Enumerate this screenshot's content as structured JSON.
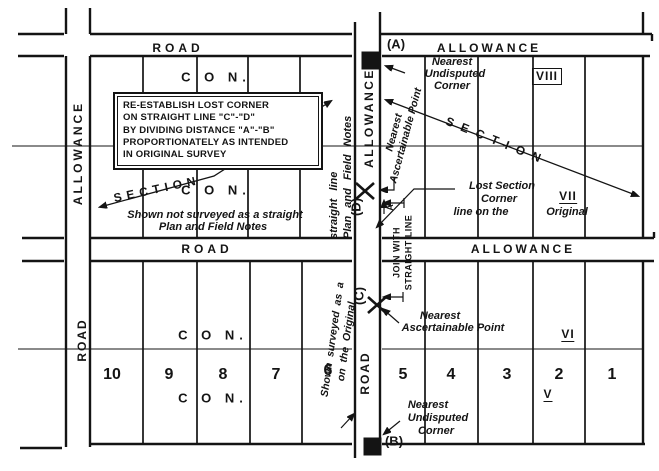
{
  "title": "Re-establishing a lost section corner — survey sketch",
  "colors": {
    "ink": "#141414",
    "bg": "#ffffff"
  },
  "roads": {
    "top": "ROAD",
    "top_right": "ALLOWANCE",
    "middle": "ROAD",
    "middle_right": "ALLOWANCE",
    "left_upper": "ALLOWANCE",
    "left_lower": "ROAD",
    "central_upper": "ALLOWANCE",
    "central_lower": "ROAD"
  },
  "note_box": {
    "lines": [
      "RE-ESTABLISH LOST CORNER",
      "ON STRAIGHT LINE \"C\"-\"D\"",
      "BY DIVIDING DISTANCE \"A\"-\"B\"",
      "PROPORTIONATELY AS INTENDED",
      "IN ORIGINAL SURVEY"
    ]
  },
  "section_labels": {
    "left": "SECTION",
    "right": "SECTION"
  },
  "concession_labels": {
    "top_upper": "C O N.",
    "top_lower": "C O N.",
    "bottom_upper": "C O N.",
    "bottom_lower": "C O N."
  },
  "concession_numerals": {
    "viii": "VIII",
    "vii": "VII",
    "vi": "VI",
    "v": "V"
  },
  "lots": {
    "bottom_left": [
      "10",
      "9",
      "8",
      "7",
      "6"
    ],
    "bottom_right": [
      "5",
      "4",
      "3",
      "2",
      "1"
    ]
  },
  "points": {
    "a": "(A)",
    "b": "(B)",
    "c": "(C)",
    "d": "(D)",
    "dim": "A"
  },
  "annotations": {
    "nearest_undisputed_top": {
      "l1": "Nearest",
      "l2": "Undisputed",
      "l3": "Corner"
    },
    "nearest_undisputed_bottom": {
      "l1": "Nearest",
      "l2": "Undisputed",
      "l3": "Corner"
    },
    "nearest_ascertainable_top": {
      "l1": "Nearest",
      "l2": "Ascertainable Point"
    },
    "nearest_ascertainable_bottom": {
      "l1": "Nearest",
      "l2": "Ascertainable Point"
    },
    "lost_corner": {
      "l1": "Lost Section",
      "l2": "Corner",
      "l3": "line on the",
      "l4": "Original"
    },
    "join": {
      "l1": "JOIN WITH",
      "l2": "STRAIGHT LINE"
    },
    "shown_not": {
      "l1": "Shown not surveyed as a straight",
      "l2": "Plan and Field Notes"
    },
    "straight_plan": {
      "l1": "straight line",
      "l2": "Plan and Field Notes"
    },
    "shown_original": {
      "l1": "Shown surveyed as a",
      "l2": "on the Original"
    }
  }
}
